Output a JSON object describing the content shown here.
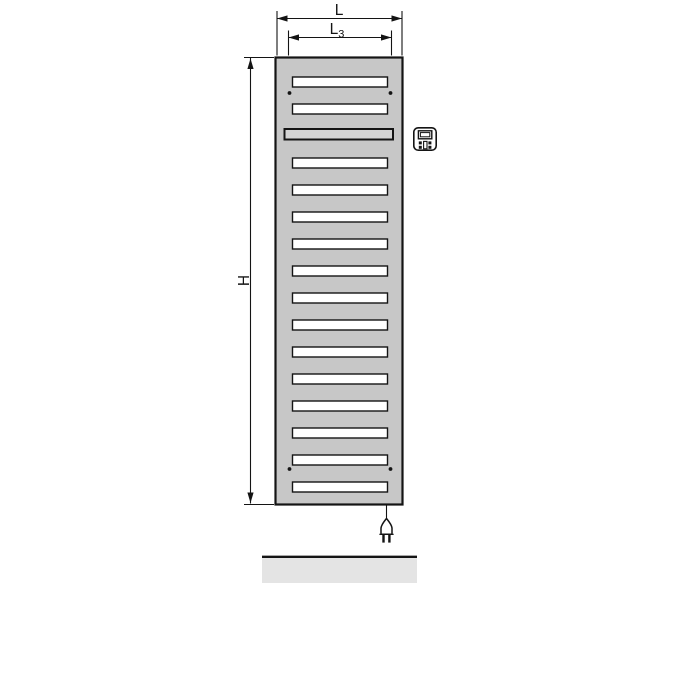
{
  "drawing": {
    "type": "dimensioned-technical-drawing",
    "subject": "electric bathroom radiator, front view",
    "dimension_labels": {
      "overall_width": {
        "main": "L"
      },
      "slot_width": {
        "main": "L",
        "sub": "3"
      },
      "overall_height": {
        "main": "H"
      }
    },
    "radiator": {
      "slot_count": 16,
      "wide_slot_position": 3,
      "mounting_hole_count": 4
    },
    "icons": {
      "control_unit": "control-unit-icon",
      "power_plug": "power-plug-icon"
    },
    "floor": {
      "present": true
    },
    "colors": {
      "line": "#141414",
      "panel_fill": "#c7c7c7",
      "slot_fill": "#ffffff",
      "wide_slot_fill": "#d3d3d3",
      "floor_fill": "#e4e4e4",
      "background": "#ffffff"
    }
  }
}
